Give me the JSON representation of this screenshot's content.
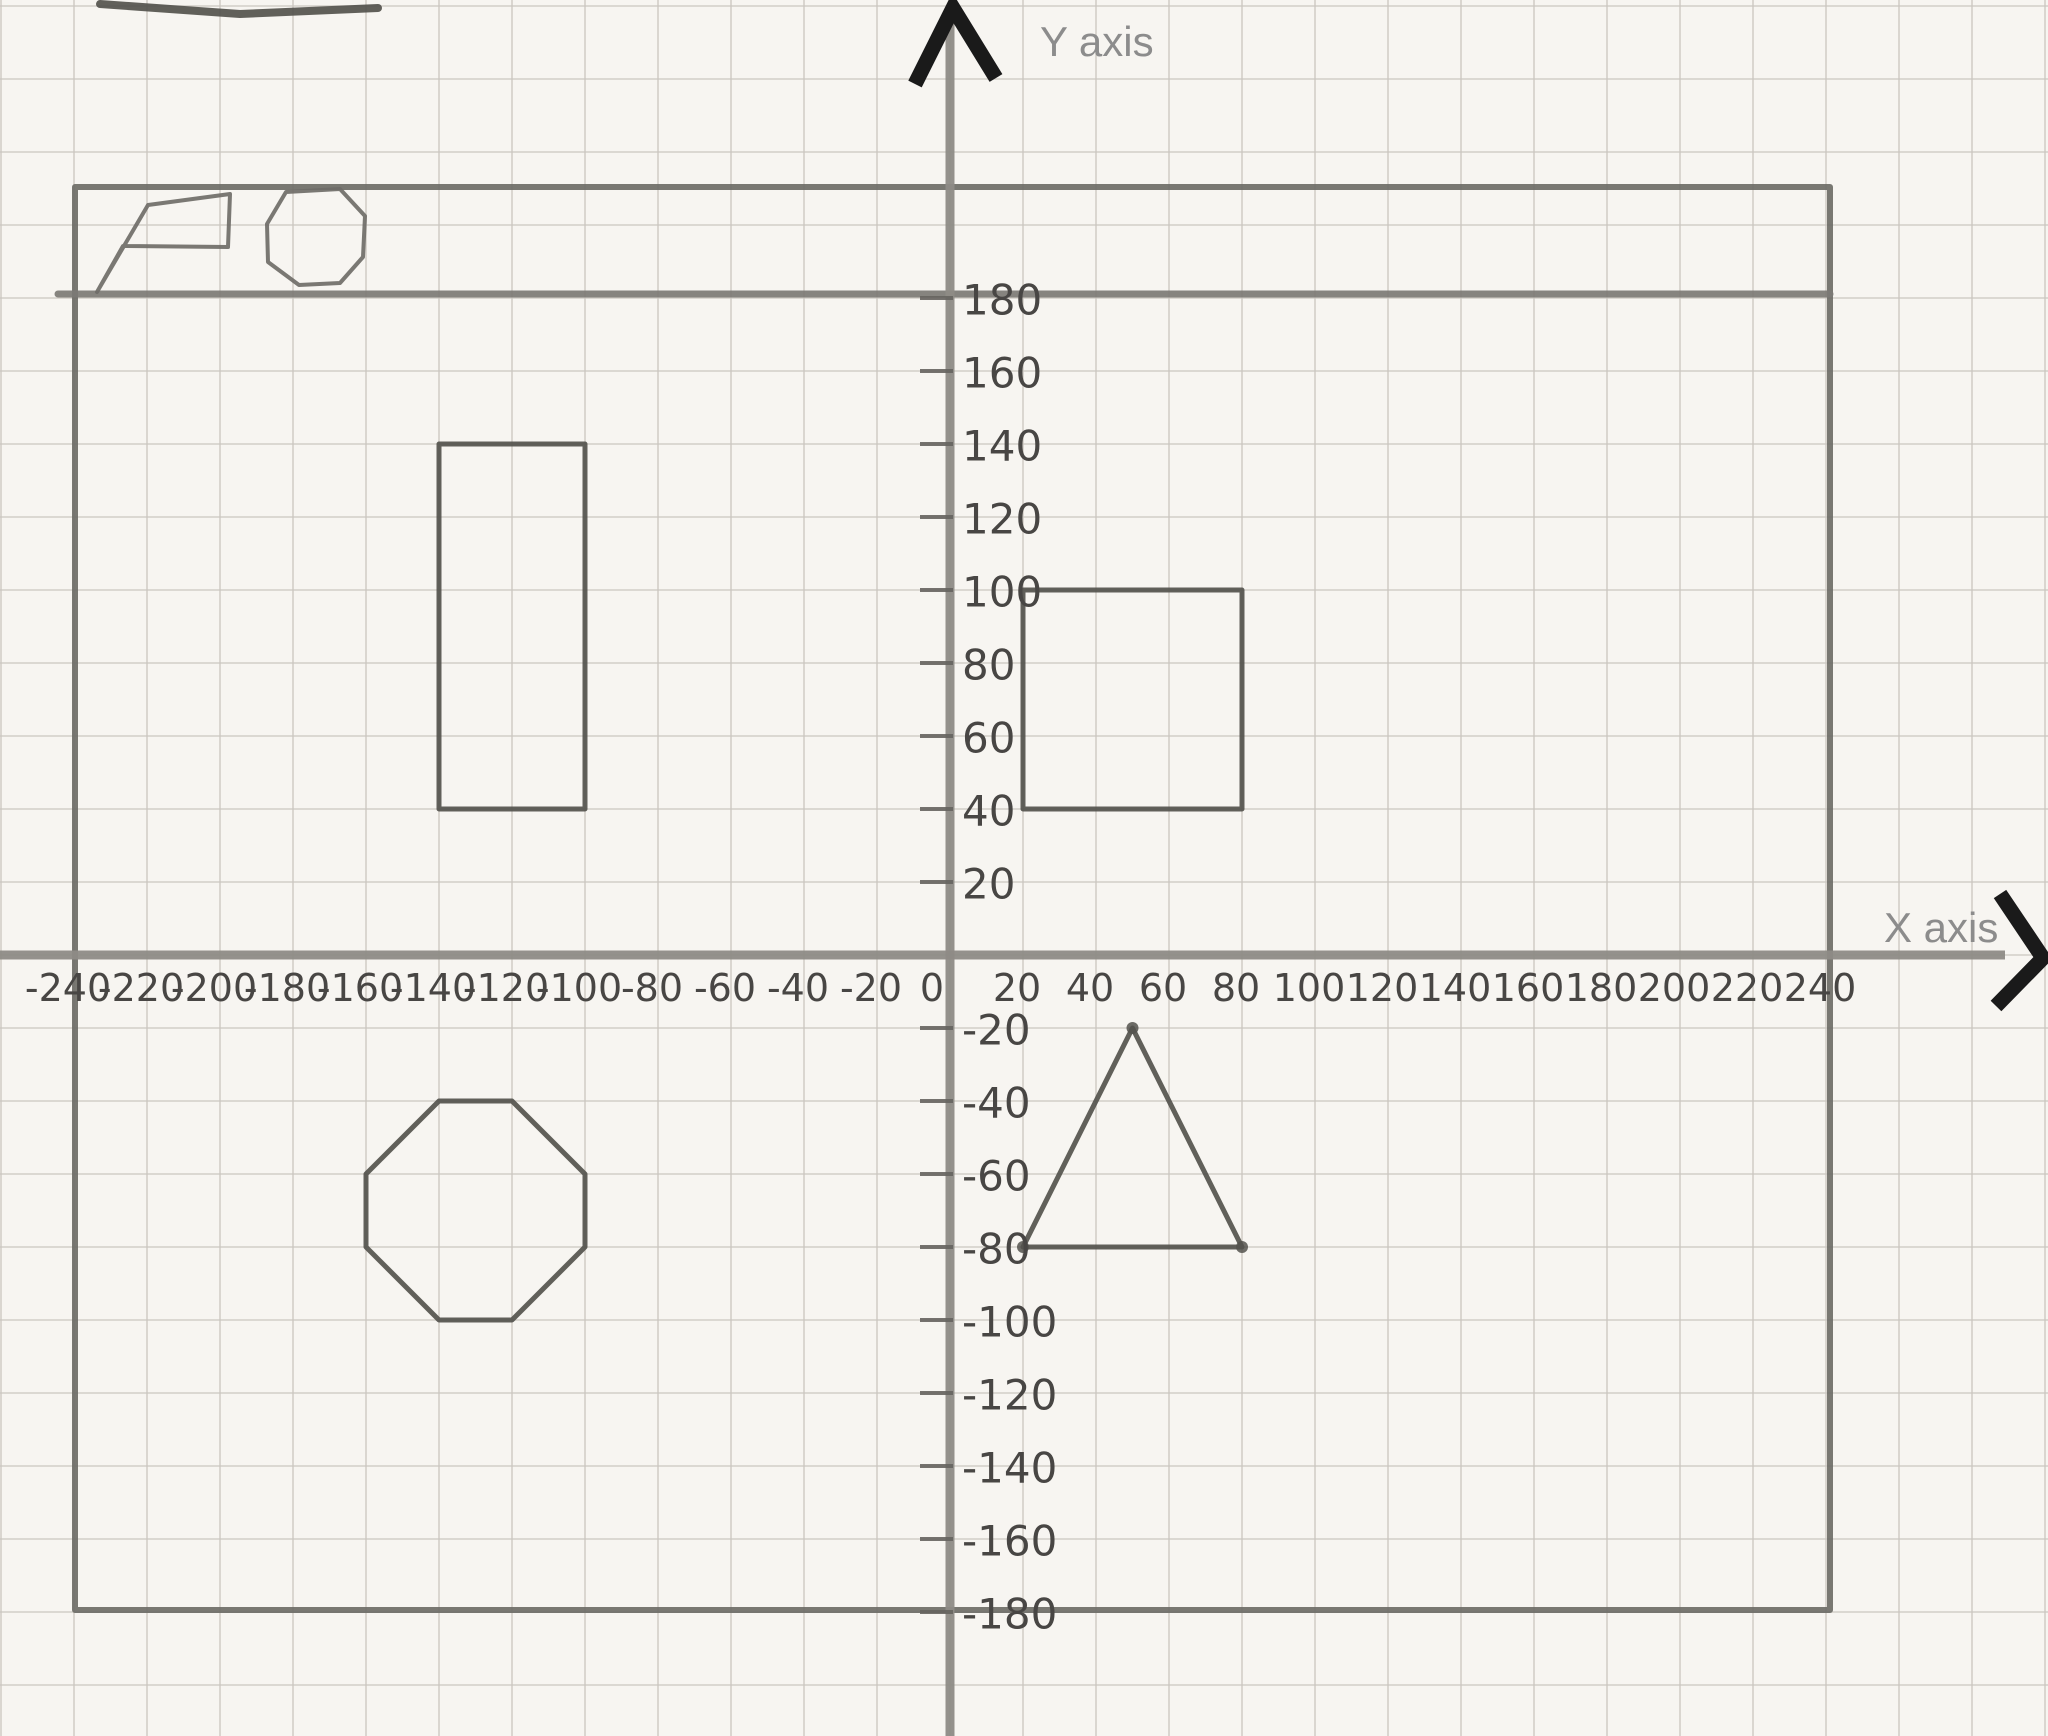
{
  "colors": {
    "paper": "#f7f5f1",
    "grid_line": "#cbc7c0",
    "pencil_dark": "#54524d",
    "pencil_border": "#6e6c67",
    "pencil_axis": "#8e8b86",
    "pencil_heavy": "#7c7a75",
    "pencil_doodle": "#6f6d68",
    "pencil_tick": "#66645f",
    "handwriting": "#484644",
    "printed_label_gray": "#8c8c8c",
    "marker_black": "#1a1a1a"
  },
  "axes": {
    "x_title": "X axis",
    "y_title": "Y axis"
  },
  "chart_data": {
    "type": "scatter",
    "title": "",
    "xlabel": "X axis",
    "ylabel": "Y axis",
    "xlim": [
      -240,
      240
    ],
    "ylim": [
      -180,
      180
    ],
    "grid": true,
    "grid_step": 20,
    "x_ticks": [
      {
        "value": -240,
        "label": "-240"
      },
      {
        "value": -220,
        "label": "-220"
      },
      {
        "value": -200,
        "label": "-200"
      },
      {
        "value": -180,
        "label": "-180"
      },
      {
        "value": -160,
        "label": "-160"
      },
      {
        "value": -140,
        "label": "-140"
      },
      {
        "value": -120,
        "label": "-120"
      },
      {
        "value": -100,
        "label": "-100"
      },
      {
        "value": -80,
        "label": "-80"
      },
      {
        "value": -60,
        "label": "-60"
      },
      {
        "value": -40,
        "label": "-40"
      },
      {
        "value": -20,
        "label": "-20"
      },
      {
        "value": 0,
        "label": "0"
      },
      {
        "value": 20,
        "label": "20"
      },
      {
        "value": 40,
        "label": "40"
      },
      {
        "value": 60,
        "label": "60"
      },
      {
        "value": 80,
        "label": "80"
      },
      {
        "value": 100,
        "label": "100"
      },
      {
        "value": 120,
        "label": "120"
      },
      {
        "value": 140,
        "label": "140"
      },
      {
        "value": 160,
        "label": "160"
      },
      {
        "value": 180,
        "label": "180"
      },
      {
        "value": 200,
        "label": "200"
      },
      {
        "value": 220,
        "label": "220"
      },
      {
        "value": 240,
        "label": "240"
      }
    ],
    "y_ticks": [
      {
        "value": 180,
        "label": "180"
      },
      {
        "value": 160,
        "label": "160"
      },
      {
        "value": 140,
        "label": "140"
      },
      {
        "value": 120,
        "label": "120"
      },
      {
        "value": 100,
        "label": "100"
      },
      {
        "value": 80,
        "label": "80"
      },
      {
        "value": 60,
        "label": "60"
      },
      {
        "value": 40,
        "label": "40"
      },
      {
        "value": 20,
        "label": "20"
      },
      {
        "value": -20,
        "label": "-20"
      },
      {
        "value": -40,
        "label": "-40"
      },
      {
        "value": -60,
        "label": "-60"
      },
      {
        "value": -80,
        "label": "-80"
      },
      {
        "value": -100,
        "label": "-100"
      },
      {
        "value": -120,
        "label": "-120"
      },
      {
        "value": -140,
        "label": "-140"
      },
      {
        "value": -160,
        "label": "-160"
      },
      {
        "value": -180,
        "label": "-180"
      }
    ],
    "shapes": [
      {
        "name": "border-rectangle",
        "units": "px",
        "closed": true,
        "color": "pencil_border",
        "width": 6,
        "points": [
          [
            75,
            187
          ],
          [
            1830,
            187
          ],
          [
            1830,
            1610
          ],
          [
            75,
            1610
          ]
        ]
      },
      {
        "name": "heavy-line-y-180",
        "units": "px",
        "closed": false,
        "color": "pencil_heavy",
        "width": 7,
        "points": [
          [
            58,
            294
          ],
          [
            1830,
            294
          ]
        ]
      },
      {
        "name": "tall-rectangle-quadrant2",
        "units": "graph",
        "closed": true,
        "color": "pencil_dark",
        "width": 5,
        "points": [
          [
            -140,
            140
          ],
          [
            -100,
            140
          ],
          [
            -100,
            40
          ],
          [
            -140,
            40
          ]
        ]
      },
      {
        "name": "square-quadrant1",
        "units": "graph",
        "closed": true,
        "color": "pencil_dark",
        "width": 5,
        "points": [
          [
            20,
            100
          ],
          [
            80,
            100
          ],
          [
            80,
            40
          ],
          [
            20,
            40
          ]
        ]
      },
      {
        "name": "octagon-quadrant3",
        "units": "graph",
        "closed": true,
        "color": "pencil_dark",
        "width": 5,
        "points": [
          [
            -140,
            -40
          ],
          [
            -120,
            -40
          ],
          [
            -100,
            -60
          ],
          [
            -100,
            -80
          ],
          [
            -120,
            -100
          ],
          [
            -140,
            -100
          ],
          [
            -160,
            -80
          ],
          [
            -160,
            -60
          ]
        ]
      },
      {
        "name": "triangle-quadrant4",
        "units": "graph",
        "closed": true,
        "color": "pencil_dark",
        "width": 5,
        "vertex_dots": true,
        "points": [
          [
            50,
            -20
          ],
          [
            80,
            -80
          ],
          [
            20,
            -80
          ]
        ]
      },
      {
        "name": "doodle-pentagon",
        "units": "px",
        "closed": true,
        "color": "pencil_doodle",
        "width": 4,
        "points": [
          [
            97,
            292
          ],
          [
            148,
            205
          ],
          [
            230,
            194
          ],
          [
            228,
            247
          ],
          [
            123,
            246
          ]
        ]
      },
      {
        "name": "doodle-octagon",
        "units": "px",
        "closed": true,
        "color": "pencil_doodle",
        "width": 4,
        "points": [
          [
            286,
            192
          ],
          [
            340,
            189
          ],
          [
            365,
            216
          ],
          [
            363,
            257
          ],
          [
            340,
            283
          ],
          [
            299,
            285
          ],
          [
            268,
            262
          ],
          [
            267,
            224
          ]
        ]
      },
      {
        "name": "doodle-top-edge-stroke",
        "units": "px",
        "closed": false,
        "color": "pencil_dark",
        "width": 8,
        "points": [
          [
            100,
            4
          ],
          [
            240,
            14
          ],
          [
            378,
            8
          ]
        ]
      }
    ],
    "arrowheads": [
      {
        "name": "y-axis-arrowhead",
        "points": [
          [
            915,
            84
          ],
          [
            953,
            8
          ],
          [
            996,
            78
          ]
        ]
      },
      {
        "name": "x-axis-arrowhead",
        "points": [
          [
            2000,
            894
          ],
          [
            2043,
            958
          ],
          [
            1996,
            1006
          ]
        ]
      }
    ],
    "layout": {
      "origin_px": [
        950,
        955
      ],
      "px_per_20_units": 73,
      "canvas_px": [
        2048,
        1736
      ],
      "legend": "none",
      "tick_label_side_y": "right-of-axis",
      "tick_label_side_x": "below-axis"
    }
  }
}
